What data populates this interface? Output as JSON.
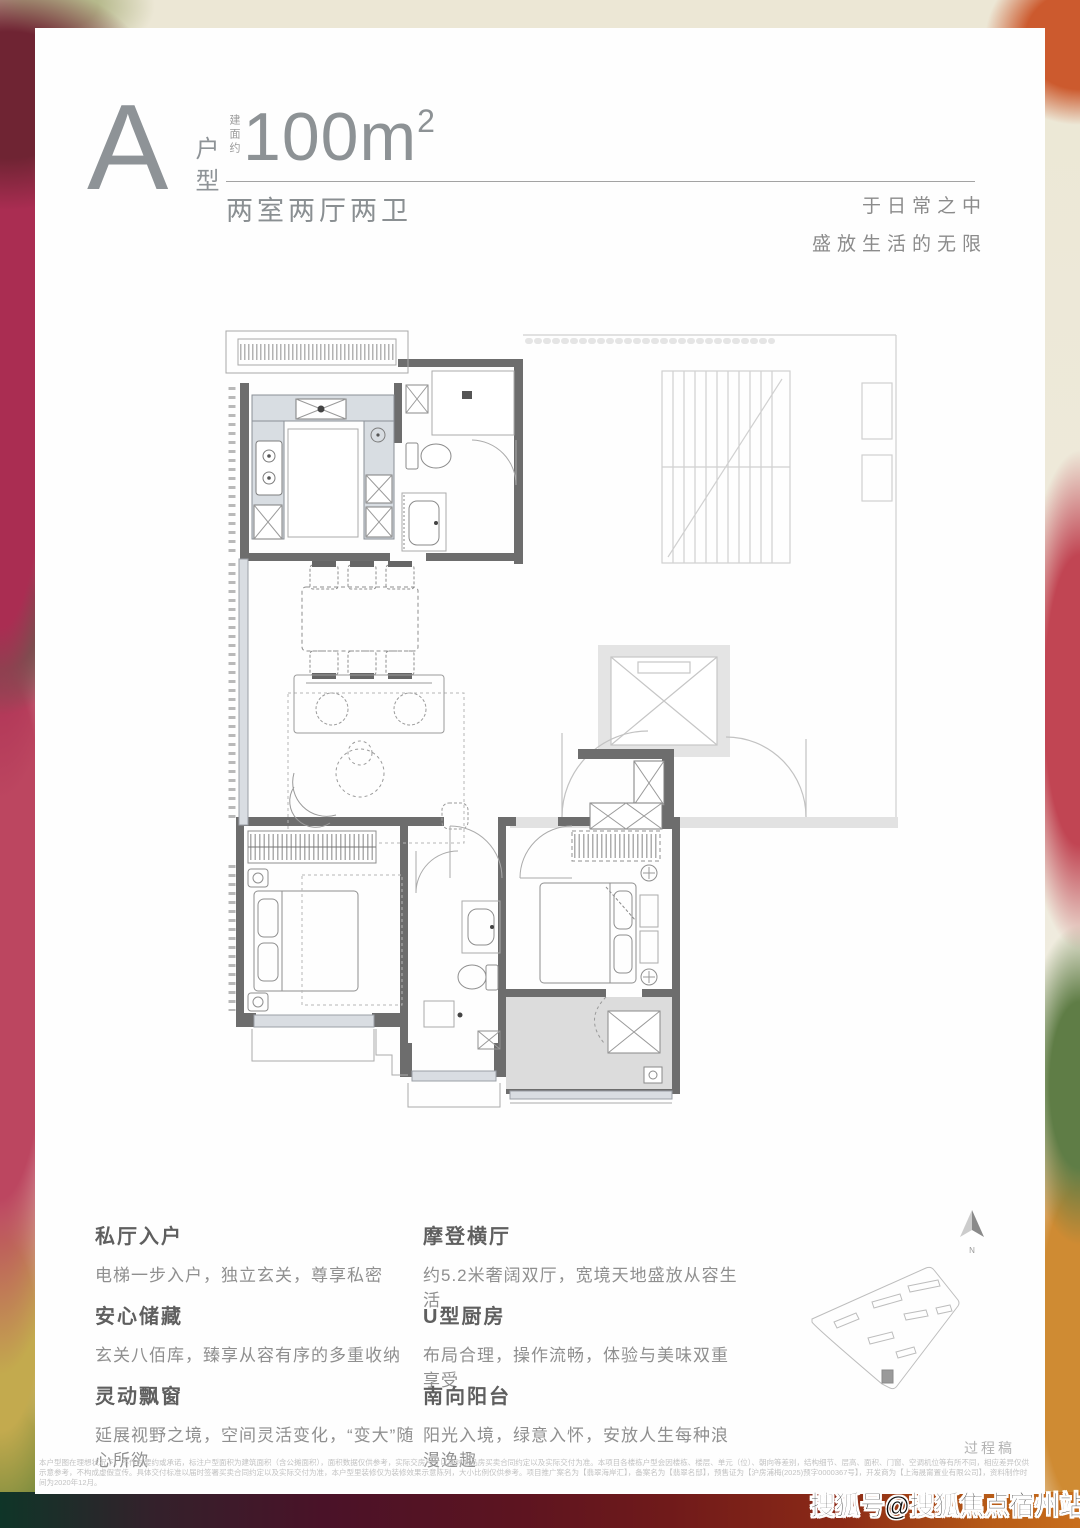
{
  "header": {
    "type_letter": "A",
    "type_label": "户型",
    "area_prefix": "建面约",
    "area_number": "100m",
    "area_exponent": "2",
    "layout_label": "两室两厅两卫"
  },
  "slogan": {
    "line1": "于日常之中",
    "line2": "盛放生活的无限"
  },
  "features": {
    "left": [
      {
        "title": "私厅入户",
        "desc": "电梯一步入户，独立玄关，尊享私密"
      },
      {
        "title": "安心储藏",
        "desc": "玄关八佰库，臻享从容有序的多重收纳"
      },
      {
        "title": "灵动飘窗",
        "desc": "延展视野之境，空间灵活变化，“变大”随心所欲"
      }
    ],
    "right": [
      {
        "title": "摩登横厅",
        "desc": "约5.2米奢阔双厅，宽境天地盛放从容生活"
      },
      {
        "title": "U型厨房",
        "desc": "布局合理，操作流畅，体验与美味双重享受"
      },
      {
        "title": "南向阳台",
        "desc": "阳光入境，绿意入怀，安放人生每种浪漫逸趣"
      }
    ]
  },
  "compass": {
    "label": "N"
  },
  "draft_note": "过程稿",
  "disclaimer": {
    "text": "本户型图在理想状况下，不作为要约或承诺，标注户型面积为建筑面积（含公摊面积），面积数据仅供参考，实际交房尺寸以届时商品房买卖合同约定以及实际交付为准。本项目各楼栋户型会因楼栋、楼层、单元（位）、朝向等差别，结构细节、层高、面积、门窗、空调机位等有所不同，相应差异仅供示意参考，不构成虚假宣传。具体交付标准以届时签署买卖合同约定以及实际交付为准，本户型里装修仅为装修效果示意陈列，大小比例仅供参考。项目推广案名为【翡翠海岸汇】，备案名为【翡翠名邸】，预售证为【沪房浦梅(2025)预字0000367号】，开发商为【上海晟甯置业有限公司】，资料制作时间为2020年12月。"
  },
  "watermark": "搜狐号@搜狐焦点宿州站",
  "colors": {
    "accent_gray": "#8e9397",
    "wall_dark": "#6d6d6d",
    "fill_light": "#d9dde2",
    "common_light": "#d0d0d0",
    "balcony_gray": "#dcdcdc"
  }
}
